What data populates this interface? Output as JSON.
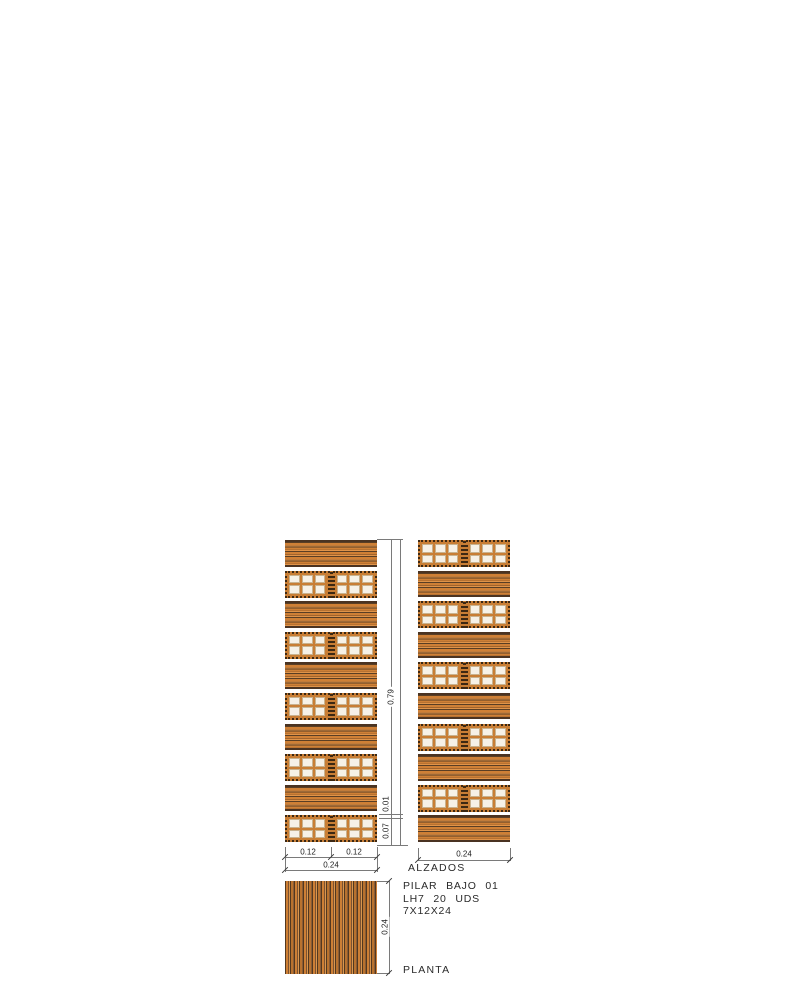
{
  "drawing": {
    "labels": {
      "elevations": "ALZADOS",
      "plan": "PLANTA"
    },
    "title_block": {
      "line1": "PILAR BAJO 01",
      "line2": "LH7 20 UDS",
      "line3": "7X12X24"
    },
    "dimensions": {
      "height_total": "0.79",
      "course_brick_height": "0.07",
      "joint_height": "0.01",
      "left_half_1": "0.12",
      "left_half_2": "0.12",
      "left_total": "0.24",
      "right_total": "0.24",
      "plan_side": "0.24"
    },
    "colors": {
      "brick_orange": "#cd7f35",
      "brick_dark": "#4a3322",
      "brick_light": "#e0944a",
      "hole_fill": "#f6f1e7",
      "dim_line": "#7a7a7a"
    },
    "elevations": {
      "left": {
        "courses": [
          "stretcher",
          "header",
          "stretcher",
          "header",
          "stretcher",
          "header",
          "stretcher",
          "header",
          "stretcher",
          "header"
        ]
      },
      "right": {
        "courses": [
          "header",
          "stretcher",
          "header",
          "stretcher",
          "header",
          "stretcher",
          "header",
          "stretcher",
          "header",
          "stretcher"
        ]
      }
    }
  }
}
